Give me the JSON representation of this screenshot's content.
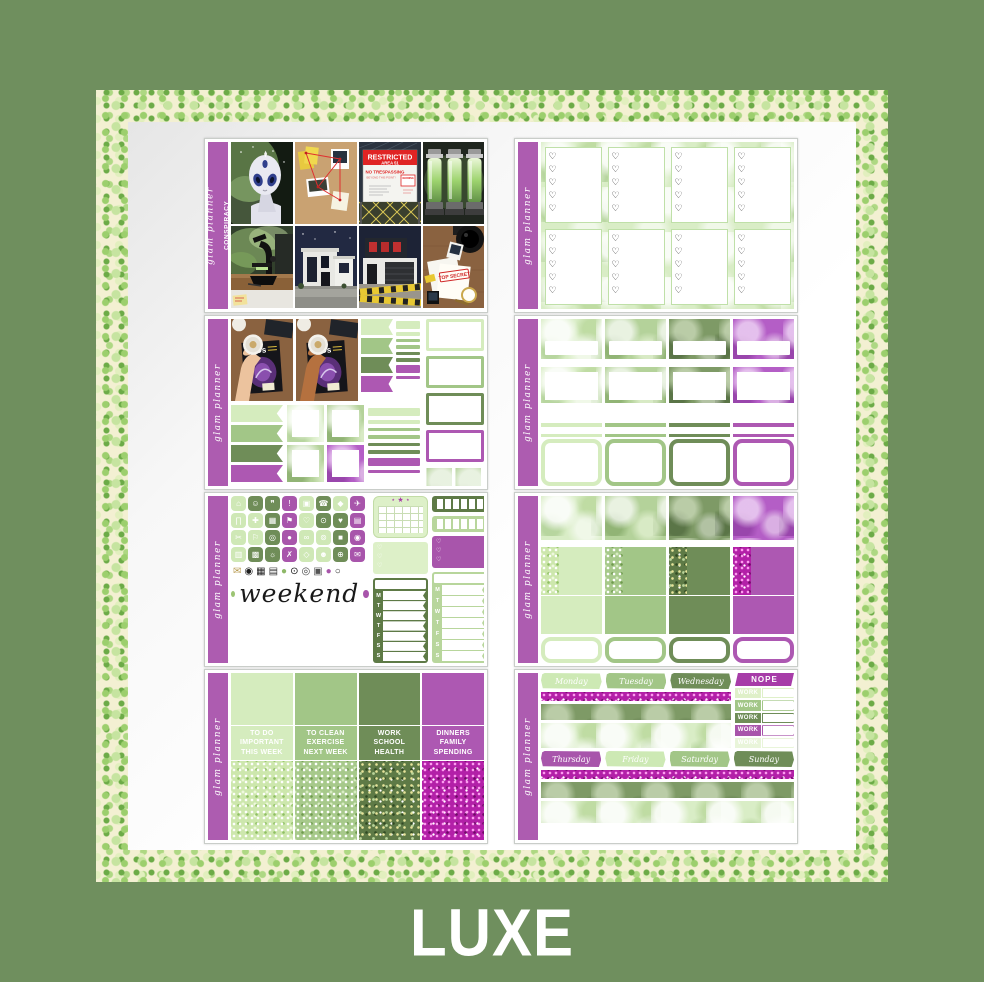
{
  "page": {
    "background_color": "#6f8f5e",
    "product_label": "LUXE",
    "brand_script": "glam planner",
    "kit_name": "CONSPIRACY"
  },
  "palette": {
    "purple": "#ad5cb0",
    "purple_deep": "#a73ca8",
    "light_green": "#d5ecbe",
    "mid_green": "#a2c687",
    "dark_green": "#6f8d58",
    "pale_green": "#e9f5da",
    "magenta_glitter": "#b320a8",
    "glitter_frame_base": "#f3f0d2"
  },
  "glyphs": {
    "heart": "♡",
    "heart_column5": "♡\n♡\n♡\n♡\n♡",
    "heart_column3": "♡\n♡\n♡",
    "marquee_stars": "⋆ ★ ⋆"
  },
  "photos": {
    "restricted_title": "RESTRICTED",
    "restricted_subtitle": "AREA 51",
    "no_trespassing_line1": "NO TRESPASSING",
    "no_trespassing_line2": "BEYOND THIS POINT!",
    "warning_label": "WARNING",
    "top_secret_stamp": "TOP SECRET",
    "magazine_title": "UFOs"
  },
  "icons_sheet": {
    "weekend_script": "weekend",
    "tracker_letters": [
      "M",
      "T",
      "W",
      "T",
      "F",
      "S",
      "S"
    ],
    "icons": [
      {
        "glyph": "⌂",
        "name": "home",
        "color": "#cfe8b6"
      },
      {
        "glyph": "☺",
        "name": "person",
        "color": "#6f8d58"
      },
      {
        "glyph": "❞",
        "name": "chat",
        "color": "#6f8d58"
      },
      {
        "glyph": "!",
        "name": "alert",
        "color": "#a855ab"
      },
      {
        "glyph": "▣",
        "name": "game",
        "color": "#cfe8b6"
      },
      {
        "glyph": "☎",
        "name": "phone",
        "color": "#6f8d58"
      },
      {
        "glyph": "◆",
        "name": "polish",
        "color": "#cfe8b6"
      },
      {
        "glyph": "✈",
        "name": "travel",
        "color": "#a855ab"
      },
      {
        "glyph": "∏",
        "name": "pants",
        "color": "#cfe8b6"
      },
      {
        "glyph": "✚",
        "name": "pill",
        "color": "#cfe8b6"
      },
      {
        "glyph": "▦",
        "name": "laptop",
        "color": "#6f8d58"
      },
      {
        "glyph": "⚑",
        "name": "flag",
        "color": "#a855ab"
      },
      {
        "glyph": "♡",
        "name": "heart-outline",
        "color": "#cfe8b6"
      },
      {
        "glyph": "⊙",
        "name": "tooth",
        "color": "#6f8d58"
      },
      {
        "glyph": "♥",
        "name": "heart",
        "color": "#6f8d58"
      },
      {
        "glyph": "▤",
        "name": "card",
        "color": "#a855ab"
      },
      {
        "glyph": "✂",
        "name": "scissors",
        "color": "#cfe8b6"
      },
      {
        "glyph": "⚐",
        "name": "banner",
        "color": "#cfe8b6"
      },
      {
        "glyph": "◎",
        "name": "bottle",
        "color": "#6f8d58"
      },
      {
        "glyph": "●",
        "name": "car",
        "color": "#a855ab"
      },
      {
        "glyph": "∞",
        "name": "rings",
        "color": "#cfe8b6"
      },
      {
        "glyph": "⊚",
        "name": "coin",
        "color": "#cfe8b6"
      },
      {
        "glyph": "■",
        "name": "money",
        "color": "#6f8d58"
      },
      {
        "glyph": "◉",
        "name": "camera",
        "color": "#a855ab"
      },
      {
        "glyph": "▥",
        "name": "shirt",
        "color": "#cfe8b6"
      },
      {
        "glyph": "▩",
        "name": "calendar",
        "color": "#6f8d58"
      },
      {
        "glyph": "☼",
        "name": "bulb",
        "color": "#6f8d58"
      },
      {
        "glyph": "✗",
        "name": "trash",
        "color": "#a855ab"
      },
      {
        "glyph": "◇",
        "name": "gem",
        "color": "#cfe8b6"
      },
      {
        "glyph": "☻",
        "name": "paw",
        "color": "#cfe8b6"
      },
      {
        "glyph": "⊕",
        "name": "clock",
        "color": "#6f8d58"
      },
      {
        "glyph": "✉",
        "name": "mail",
        "color": "#a855ab"
      }
    ],
    "deco_items": [
      {
        "glyph": "✉",
        "name": "envelope",
        "color": "#b89b50"
      },
      {
        "glyph": "◉",
        "name": "camera",
        "color": "#1e1e1e"
      },
      {
        "glyph": "▦",
        "name": "tv",
        "color": "#222222"
      },
      {
        "glyph": "▤",
        "name": "laptop",
        "color": "#333333"
      },
      {
        "glyph": "●",
        "name": "dot-green",
        "color": "#8eb868"
      },
      {
        "glyph": "⊙",
        "name": "microscope",
        "color": "#111111"
      },
      {
        "glyph": "◎",
        "name": "lens",
        "color": "#444444"
      },
      {
        "glyph": "▣",
        "name": "polaroid",
        "color": "#555555"
      },
      {
        "glyph": "●",
        "name": "dot-purple",
        "color": "#a855ab"
      },
      {
        "glyph": "○",
        "name": "magnifier",
        "color": "#222222"
      }
    ]
  },
  "flags_sheet": {
    "flag_colors": [
      "#d5ecbe",
      "#a2c687",
      "#6f8d58",
      "#ad58b2"
    ],
    "square_textures": [
      "bk-l",
      "bk-m",
      "bk-m",
      "bk-p"
    ],
    "strips": [
      {
        "color": "#d5ecbe",
        "kind": "bar"
      },
      {
        "color": "#d5ecbe",
        "kind": "line"
      },
      {
        "color": "#a2c687",
        "kind": "line"
      },
      {
        "color": "#a2c687",
        "kind": "line"
      },
      {
        "color": "#6f8d58",
        "kind": "line"
      },
      {
        "color": "#6f8d58",
        "kind": "line"
      },
      {
        "color": "#ad58b2",
        "kind": "bar"
      },
      {
        "color": "#ad58b2",
        "kind": "line"
      }
    ],
    "pennant_textures": [
      "bk-m",
      "bk-m"
    ]
  },
  "todo_sheet": {
    "columns": [
      {
        "color": "#d5ecbe",
        "glitter": "gl-l",
        "lines": [
          "TO DO",
          "IMPORTANT",
          "THIS WEEK"
        ]
      },
      {
        "color": "#a2c687",
        "glitter": "gl-m",
        "lines": [
          "TO CLEAN",
          "EXERCISE",
          "NEXT WEEK"
        ]
      },
      {
        "color": "#6f8d58",
        "glitter": "gl-d",
        "lines": [
          "WORK",
          "SCHOOL",
          "HEALTH"
        ]
      },
      {
        "color": "#ad58b2",
        "glitter": "gl-p",
        "lines": [
          "DINNERS",
          "FAMILY",
          "SPENDING"
        ]
      }
    ]
  },
  "swatch_sheet": {
    "columns": [
      {
        "color": "#d5ecbe",
        "bokeh": "bk-l",
        "glitter": "gl-l"
      },
      {
        "color": "#a2c687",
        "bokeh": "bk-m",
        "glitter": "gl-m"
      },
      {
        "color": "#6f8d58",
        "bokeh": "bk-d",
        "glitter": "gl-d"
      },
      {
        "color": "#ad58b2",
        "bokeh": "bk-p",
        "glitter": "gl-p"
      }
    ]
  },
  "weekly_sheet": {
    "nope_label": "NOPE",
    "days_row1": [
      {
        "label": "Monday",
        "color": "#cde9b4"
      },
      {
        "label": "Tuesday",
        "color": "#a2c687"
      },
      {
        "label": "Wednesday",
        "color": "#6f8d58"
      }
    ],
    "days_row2": [
      {
        "label": "Thursday",
        "color": "#a855ab"
      },
      {
        "label": "Friday",
        "color": "#cde9b4"
      },
      {
        "label": "Saturday",
        "color": "#a2c687"
      },
      {
        "label": "Sunday",
        "color": "#6f8d58"
      }
    ],
    "work_flags": [
      {
        "label": "WORK",
        "color": "#dff0c9"
      },
      {
        "label": "WORK",
        "color": "#a2c687"
      },
      {
        "label": "WORK",
        "color": "#6f8d58"
      },
      {
        "label": "WORK",
        "color": "#a855ab"
      },
      {
        "label": "WORK",
        "color": "#e9f5da"
      }
    ]
  }
}
